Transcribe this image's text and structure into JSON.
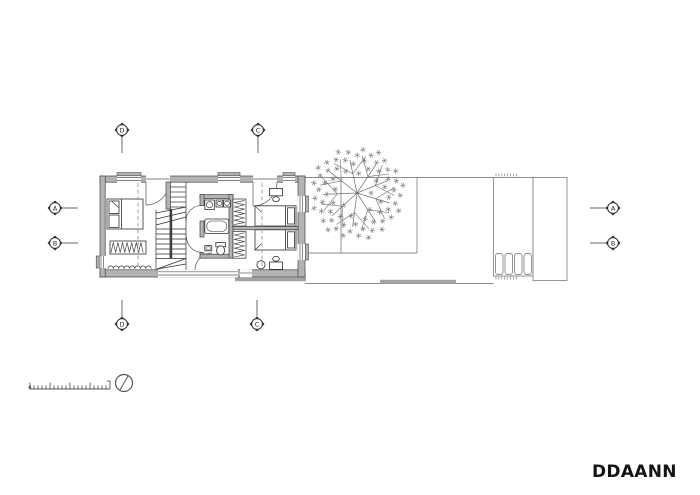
{
  "plan": {
    "grid_markers": {
      "top": [
        {
          "label": "D"
        },
        {
          "label": "C"
        }
      ],
      "bottom": [
        {
          "label": "D"
        },
        {
          "label": "C"
        }
      ],
      "left": [
        {
          "label": "A"
        },
        {
          "label": "B"
        }
      ],
      "right": [
        {
          "label": "A"
        },
        {
          "label": "B"
        }
      ]
    }
  },
  "footer": {
    "logo_text": "DDAANN"
  },
  "colors": {
    "background": "#ffffff",
    "wall_fill": "#b3b3b3",
    "wall_outline": "#444444",
    "furniture_line": "#2e2e2e",
    "site_line": "#8a8a8a",
    "tree_line": "#6f6f6f",
    "marker_dark": "#2b2b2b",
    "sill_bar": "#a3a3a3"
  }
}
